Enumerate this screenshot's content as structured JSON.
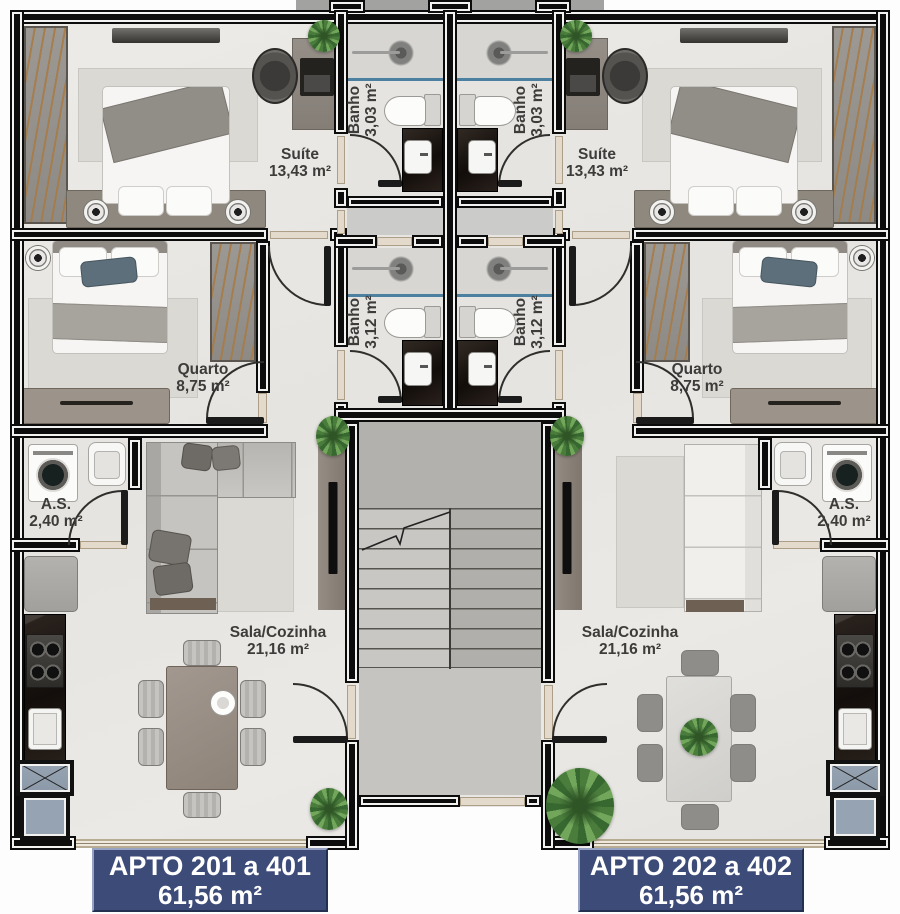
{
  "rooms": [
    {
      "name": "Suíte",
      "area": "13,43 m²"
    },
    {
      "name": "Banho",
      "area": "3,03 m²"
    },
    {
      "name": "Banho",
      "area": "3,03 m²"
    },
    {
      "name": "Suíte",
      "area": "13,43 m²"
    },
    {
      "name": "Quarto",
      "area": "8,75 m²"
    },
    {
      "name": "Banho",
      "area": "3,12 m²"
    },
    {
      "name": "Banho",
      "area": "3,12 m²"
    },
    {
      "name": "Quarto",
      "area": "8,75 m²"
    },
    {
      "name": "A.S.",
      "area": "2,40 m²"
    },
    {
      "name": "A.S.",
      "area": "2,40 m²"
    },
    {
      "name": "Sala/Cozinha",
      "area": "21,16 m²"
    },
    {
      "name": "Sala/Cozinha",
      "area": "21,16 m²"
    }
  ],
  "badges": [
    {
      "line1": "APTO 201 a 401",
      "line2": "61,56 m²"
    },
    {
      "line1": "APTO 202 a 402",
      "line2": "61,56 m²"
    }
  ],
  "colors": {
    "badge_bg": "#3c4b78",
    "wall": "#0c0c0c",
    "shower_line": "#4b80a1",
    "floor": "#eae8e4",
    "stair_floor": "#c6c4c0"
  }
}
